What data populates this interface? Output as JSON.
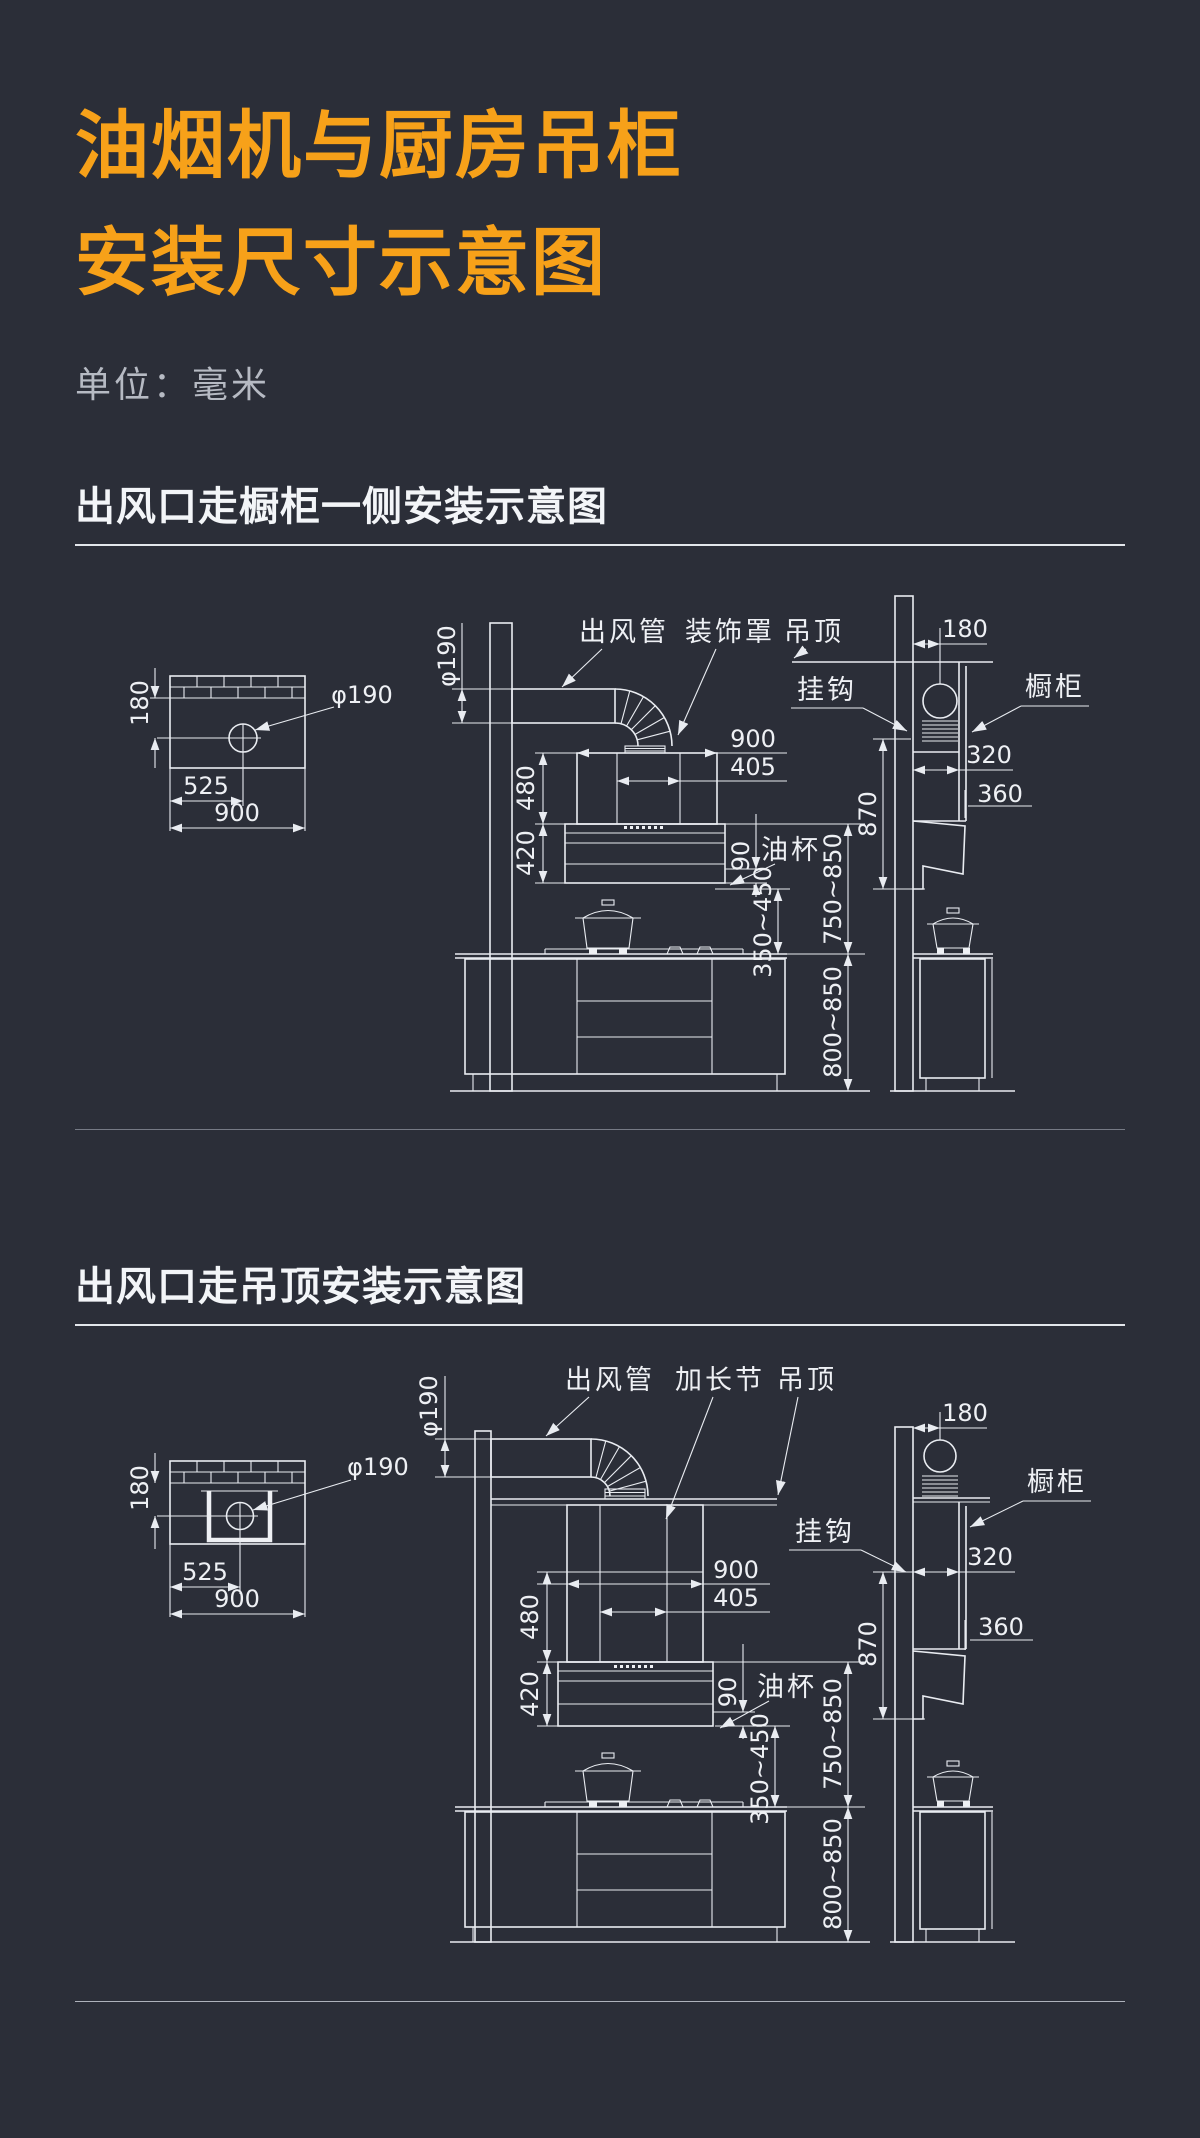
{
  "page": {
    "title_line1": "油烟机与厨房吊柜",
    "title_line2": "安装尺寸示意图",
    "unit_label": "单位：毫米",
    "colors": {
      "background": "#2b2e38",
      "accent_orange": "#f7a119",
      "line": "#e9ecf1"
    }
  },
  "section1": {
    "heading": "出风口走橱柜一侧安装示意图",
    "labels": {
      "duct": "出风管",
      "cover": "装饰罩",
      "ceiling": "吊顶",
      "hook": "挂钩",
      "cabinet": "橱柜",
      "oilcup": "油杯"
    },
    "dims": {
      "dia_hole": "φ190",
      "dia_duct": "φ190",
      "d180": "180",
      "d525": "525",
      "d900_wall": "900",
      "d480": "480",
      "d420": "420",
      "d90": "90",
      "d900": "900",
      "d405": "405",
      "d180_side": "180",
      "d320": "320",
      "d360": "360",
      "d870": "870",
      "r350": "350~450",
      "r750": "750~850",
      "r800": "800~850"
    }
  },
  "section2": {
    "heading": "出风口走吊顶安装示意图",
    "labels": {
      "duct": "出风管",
      "extension": "加长节",
      "ceiling": "吊顶",
      "hook": "挂钩",
      "cabinet": "橱柜",
      "oilcup": "油杯"
    },
    "dims": {
      "dia_hole": "φ190",
      "dia_duct": "φ190",
      "d180": "180",
      "d525": "525",
      "d900_wall": "900",
      "d480": "480",
      "d420": "420",
      "d90": "90",
      "d900": "900",
      "d405": "405",
      "d180_side": "180",
      "d320": "320",
      "d360": "360",
      "d870": "870",
      "r350": "350~450",
      "r750": "750~850",
      "r800": "800~850"
    }
  }
}
